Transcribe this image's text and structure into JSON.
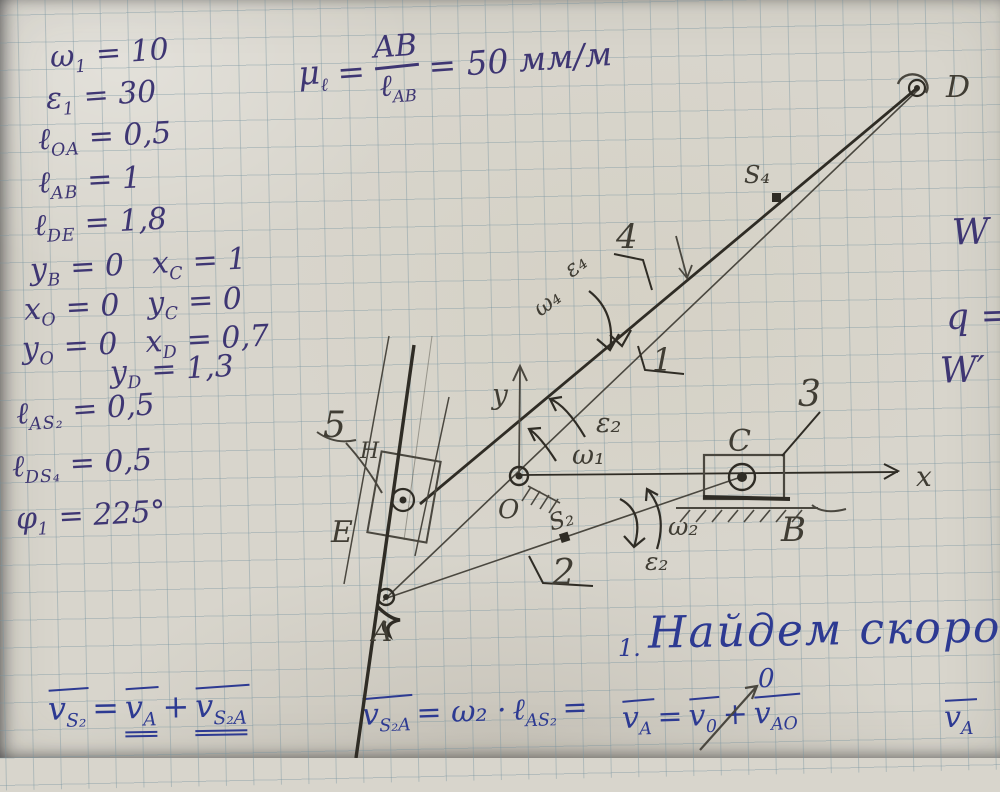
{
  "given": {
    "rows": [
      {
        "s1": "ω",
        "sub1": "1",
        "v1": " = 10",
        "s2": "",
        "sub2": "",
        "v2": ""
      },
      {
        "s1": "ε",
        "sub1": "1",
        "v1": " = 30",
        "s2": "",
        "sub2": "",
        "v2": ""
      },
      {
        "s1": "ℓ",
        "sub1": "OA",
        "v1": " = 0,5",
        "s2": "",
        "sub2": "",
        "v2": ""
      },
      {
        "s1": "ℓ",
        "sub1": "AB",
        "v1": " = 1",
        "s2": "",
        "sub2": "",
        "v2": ""
      },
      {
        "s1": "ℓ",
        "sub1": "DE",
        "v1": " = 1,8",
        "s2": "",
        "sub2": "",
        "v2": ""
      },
      {
        "s1": "y",
        "sub1": "B",
        "v1": " = 0",
        "s2": "x",
        "sub2": "C",
        "v2": " = 1"
      },
      {
        "s1": "x",
        "sub1": "O",
        "v1": " = 0",
        "s2": "y",
        "sub2": "C",
        "v2": " = 0"
      },
      {
        "s1": "y",
        "sub1": "O",
        "v1": " = 0",
        "s2": "x",
        "sub2": "D",
        "v2": " = 0,7"
      },
      {
        "s1": "y",
        "sub1": "D",
        "v1": " = 1,3",
        "s2": "",
        "sub2": "",
        "v2": ""
      },
      {
        "s1": "ℓ",
        "sub1": "AS₂",
        "v1": " = 0,5",
        "s2": "",
        "sub2": "",
        "v2": ""
      },
      {
        "s1": "ℓ",
        "sub1": "DS₄",
        "v1": " = 0,5",
        "s2": "",
        "sub2": "",
        "v2": ""
      },
      {
        "s1": "φ",
        "sub1": "1",
        "v1": " = 225°",
        "s2": "",
        "sub2": "",
        "v2": ""
      }
    ]
  },
  "scale": {
    "mu": "μ",
    "muSub": "ℓ",
    "eq": "=",
    "num": "AB",
    "den": "ℓ",
    "denSub": "AB",
    "result": "= 50 мм/м"
  },
  "margin": {
    "w": "W",
    "q": "q =",
    "w2": "W′"
  },
  "diagram": {
    "axisX": "x",
    "axisY": "y",
    "pointO": "O",
    "pointA": "A",
    "pointB": "B",
    "pointC": "C",
    "pointD": "D",
    "pointE": "E",
    "pointH": "H",
    "link1": "1",
    "link2": "2",
    "link3": "3",
    "link4": "4",
    "link5": "5",
    "s2": "S₂",
    "s4": "S₄",
    "omega1": "ω₁",
    "eps2_crank": "ε₂",
    "omega2": "ω₂",
    "eps2_link2": "ε₂",
    "omega4": "ω₄",
    "eps4": "ε₄",
    "zeroMark": "0"
  },
  "section": {
    "number": "1.",
    "title": "Найдем скорост"
  },
  "formulas": {
    "f1": {
      "v1": "v",
      "s1": "S₂",
      "eq": "=",
      "v2": "v",
      "s2": "A",
      "plus": "+",
      "v3": "v",
      "s3": "S₂A"
    },
    "f2": {
      "v": "v",
      "vsub": "S₂A",
      "mid": "= ω₂ · ",
      "l": "ℓ",
      "lsub": "AS₂",
      "tail": "="
    },
    "f3": {
      "v1": "v",
      "s1": "A",
      "eq": "=",
      "v2": "v",
      "s2": "0",
      "plus": "+",
      "v3": "v",
      "s3": "AO"
    },
    "f4": {
      "v": "v",
      "s": "A"
    },
    "colors": {
      "pen": "#3e3673",
      "blue": "#2d3a92",
      "pencil": "#4a473f"
    }
  }
}
